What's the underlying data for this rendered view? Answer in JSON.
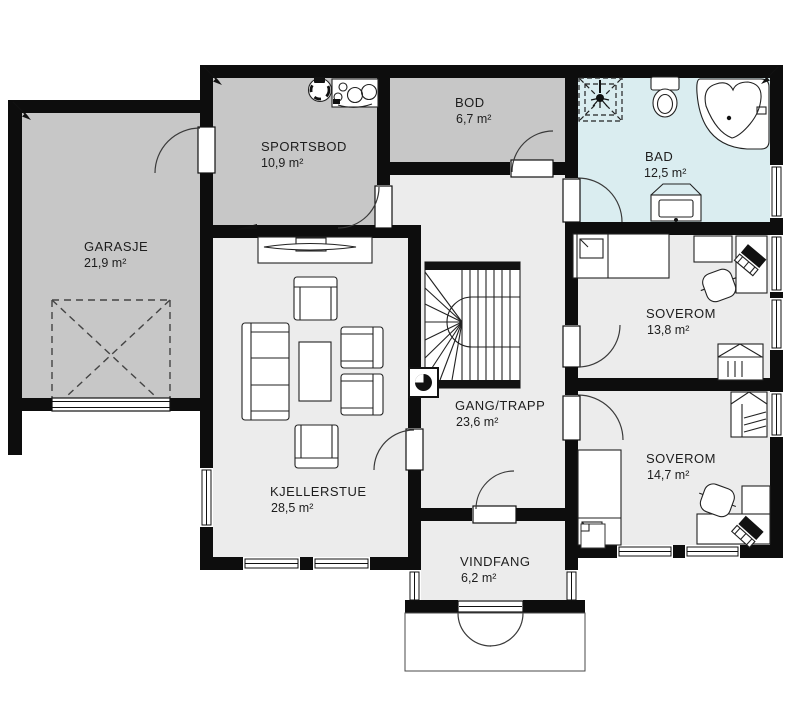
{
  "plan": {
    "type": "floor-plan",
    "rooms": [
      {
        "name": "GARASJE",
        "area": "21,9 m²"
      },
      {
        "name": "SPORTSBOD",
        "area": "10,9 m²"
      },
      {
        "name": "BOD",
        "area": "6,7 m²"
      },
      {
        "name": "BAD",
        "area": "12,5 m²"
      },
      {
        "name": "SOVEROM",
        "area": "13,8 m²"
      },
      {
        "name": "SOVEROM",
        "area": "14,7 m²"
      },
      {
        "name": "GANG/TRAPP",
        "area": "23,6 m²"
      },
      {
        "name": "KJELLERSTUE",
        "area": "28,5 m²"
      },
      {
        "name": "VINDFANG",
        "area": "6,2 m²"
      }
    ],
    "colors": {
      "wall": "#0d0d0d",
      "unheated": "#c7c7c7",
      "heated": "#ececec",
      "bath": "#daedf0",
      "background": "#ffffff"
    },
    "fixtures": [
      "stairs-icon",
      "shower-icon",
      "toilet-icon",
      "corner-bathtub-icon",
      "vanity-sink-icon",
      "laundry-sink-icon",
      "counter-icon",
      "sofa-icon",
      "armchair-icon",
      "coffee-table-icon",
      "tv-bench-icon",
      "bed-icon",
      "wardrobe-icon",
      "desk-icon",
      "office-chair-icon",
      "laptop-icon",
      "chimney-icon",
      "garage-door-swing-icon",
      "entrance-double-door-icon"
    ]
  }
}
